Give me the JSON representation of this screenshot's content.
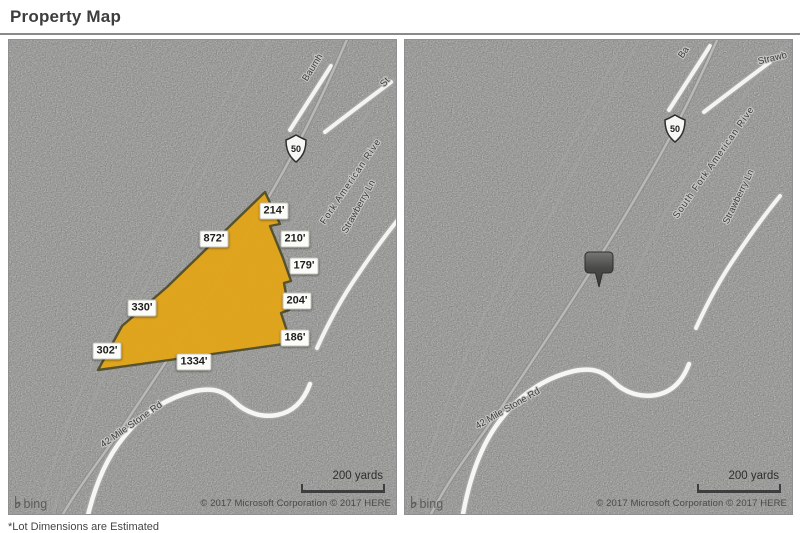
{
  "page": {
    "title": "Property Map",
    "footnote": "*Lot Dimensions are Estimated"
  },
  "map_shared": {
    "scale_label": "200 yards",
    "copyright": "© 2017 Microsoft Corporation © 2017 HERE",
    "bing_icon": "♭",
    "bing_label": "bing",
    "route_shield": "50",
    "map_bg_color": "#bbbbb9",
    "parcel_fill_color": "#e2a418",
    "parcel_border_color": "#56522e",
    "pin_color": "#4a4a4a"
  },
  "left_map": {
    "labels": {
      "baumhoff": "Baumh",
      "strawberry_short": "St",
      "river": "Fork American Rive",
      "strawberry_ln": "Strawberry Ln",
      "mile_stone": "42 Mile Stone Rd"
    },
    "parcel_dimensions": [
      "214'",
      "872'",
      "210'",
      "179'",
      "204'",
      "186'",
      "330'",
      "302'",
      "1334'"
    ]
  },
  "right_map": {
    "labels": {
      "baumhoff": "Ba",
      "strawberry_short": "Strawb",
      "river": "South Fork American Rive",
      "strawberry_ln": "Strawberry Ln",
      "mile_stone": "42 Mile Stone Rd"
    }
  }
}
